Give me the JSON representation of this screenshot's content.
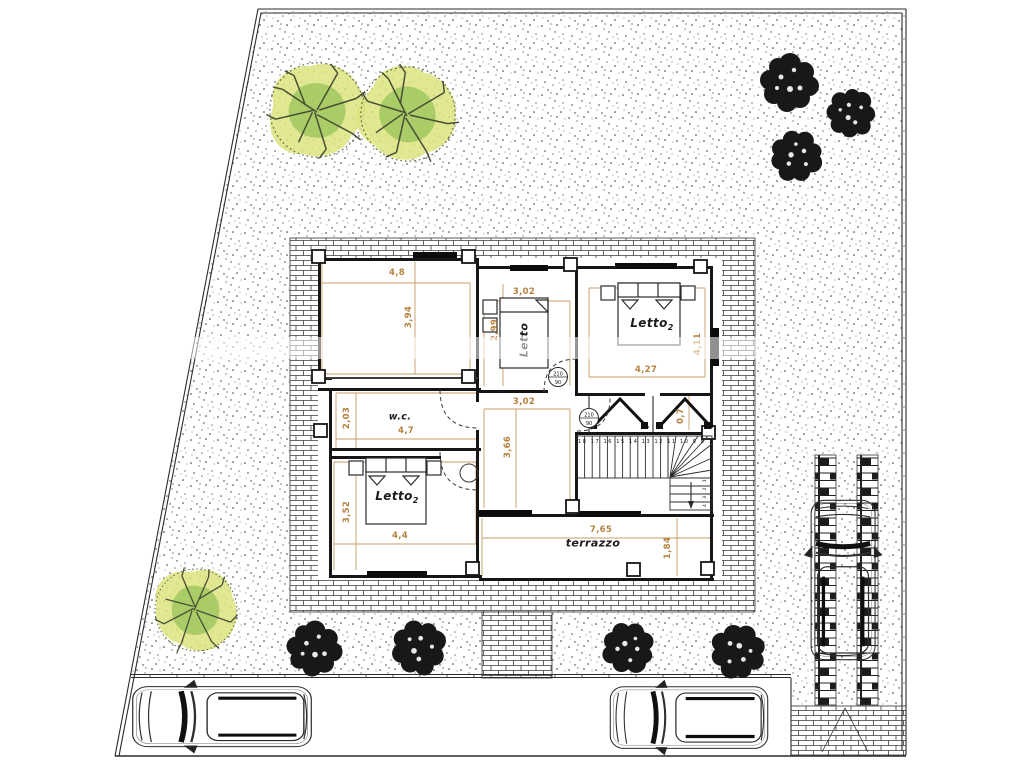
{
  "meta": {
    "type": "architectural-site-plan",
    "floor": "first-floor-with-garden",
    "language": "it"
  },
  "colors": {
    "line": "#2b2b2b",
    "dimension": "#b5823f",
    "tree_yellow": "#dde37f",
    "tree_green": "#8dbf52",
    "bush_black": "#181818"
  },
  "plan": {
    "rooms": {
      "wc": "w.c.",
      "letto_mid": "Letto",
      "letto_right": "Letto",
      "letto_right_sub": "2",
      "letto_left": "Letto",
      "letto_left_sub": "2",
      "terrace": "terrazzo"
    },
    "dimensions": [
      {
        "id": "terrace-width",
        "text": "4,8",
        "orientation": "h"
      },
      {
        "id": "terrace-depth",
        "text": "3,94",
        "orientation": "v"
      },
      {
        "id": "room-top-width",
        "text": "3,02",
        "orientation": "h"
      },
      {
        "id": "room-top-depth",
        "text": "2,99",
        "orientation": "v"
      },
      {
        "id": "bedroom-right-depth",
        "text": "4,11",
        "orientation": "v"
      },
      {
        "id": "bedroom-right-width",
        "text": "4,27",
        "orientation": "h"
      },
      {
        "id": "hall-width",
        "text": "3,02",
        "orientation": "h"
      },
      {
        "id": "hall-depth",
        "text": "3,66",
        "orientation": "v"
      },
      {
        "id": "wc-depth",
        "text": "2,03",
        "orientation": "v"
      },
      {
        "id": "wc-width",
        "text": "4,7",
        "orientation": "h"
      },
      {
        "id": "bedroom-left-depth",
        "text": "3,52",
        "orientation": "v"
      },
      {
        "id": "bedroom-left-width",
        "text": "4,4",
        "orientation": "h"
      },
      {
        "id": "terrazzo-width",
        "text": "7,65",
        "orientation": "h"
      },
      {
        "id": "terrazzo-depth",
        "text": "1,84",
        "orientation": "v"
      },
      {
        "id": "closet-depth",
        "text": "0,7",
        "orientation": "v"
      }
    ],
    "door_tags": [
      {
        "h": "210",
        "w": "90"
      },
      {
        "h": "210",
        "w": "90"
      }
    ],
    "stairs": {
      "upper_numbers": "18 17 16 15 14 13 12 11 10 9 8 7",
      "lower_numbers": "4 3 2 1"
    }
  }
}
